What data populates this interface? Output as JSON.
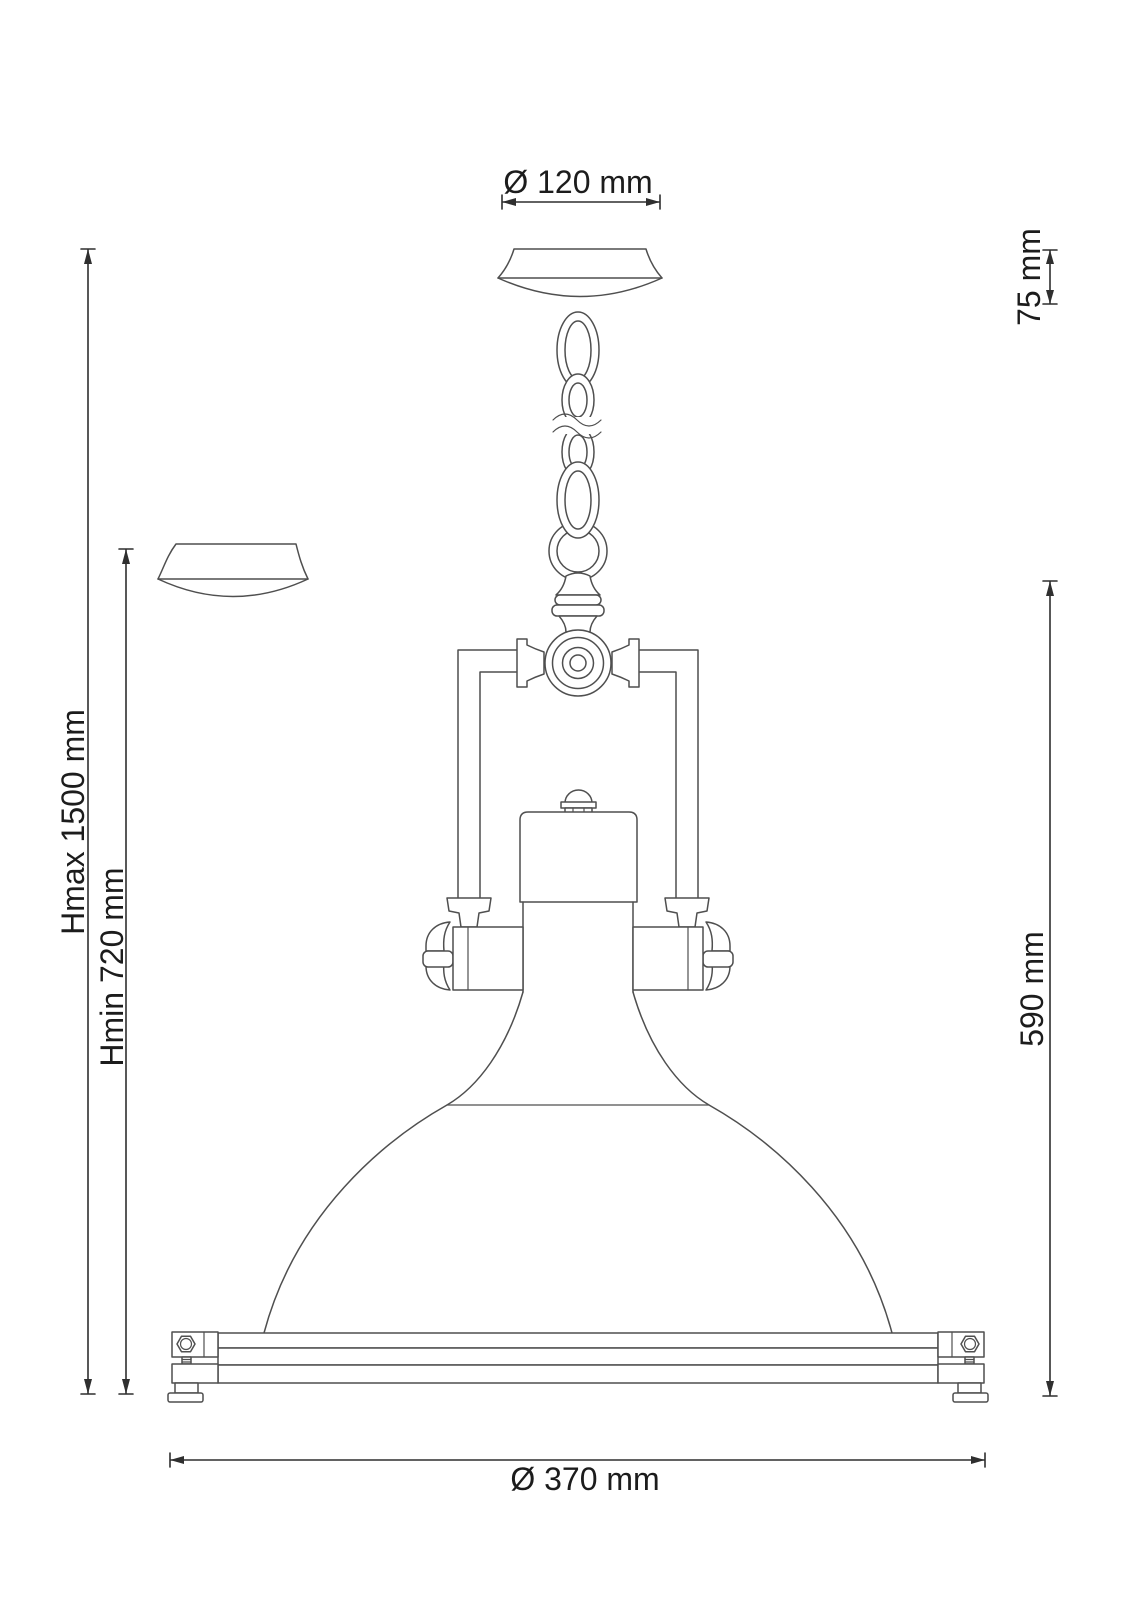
{
  "drawing": {
    "subject": "pendant-lamp-dimension-drawing",
    "colors": {
      "line": "#4f4f4f",
      "dimension": "#2f2f2f",
      "text": "#1c1c1c",
      "background": "#ffffff"
    },
    "labels": {
      "canopy_diameter": "Ø 120 mm",
      "canopy_height": "75 mm",
      "max_hanging_height": "Hmax 1500 mm",
      "min_hanging_height": "Hmin 720 mm",
      "fixture_height": "590 mm",
      "shade_diameter": "Ø 370 mm"
    }
  }
}
